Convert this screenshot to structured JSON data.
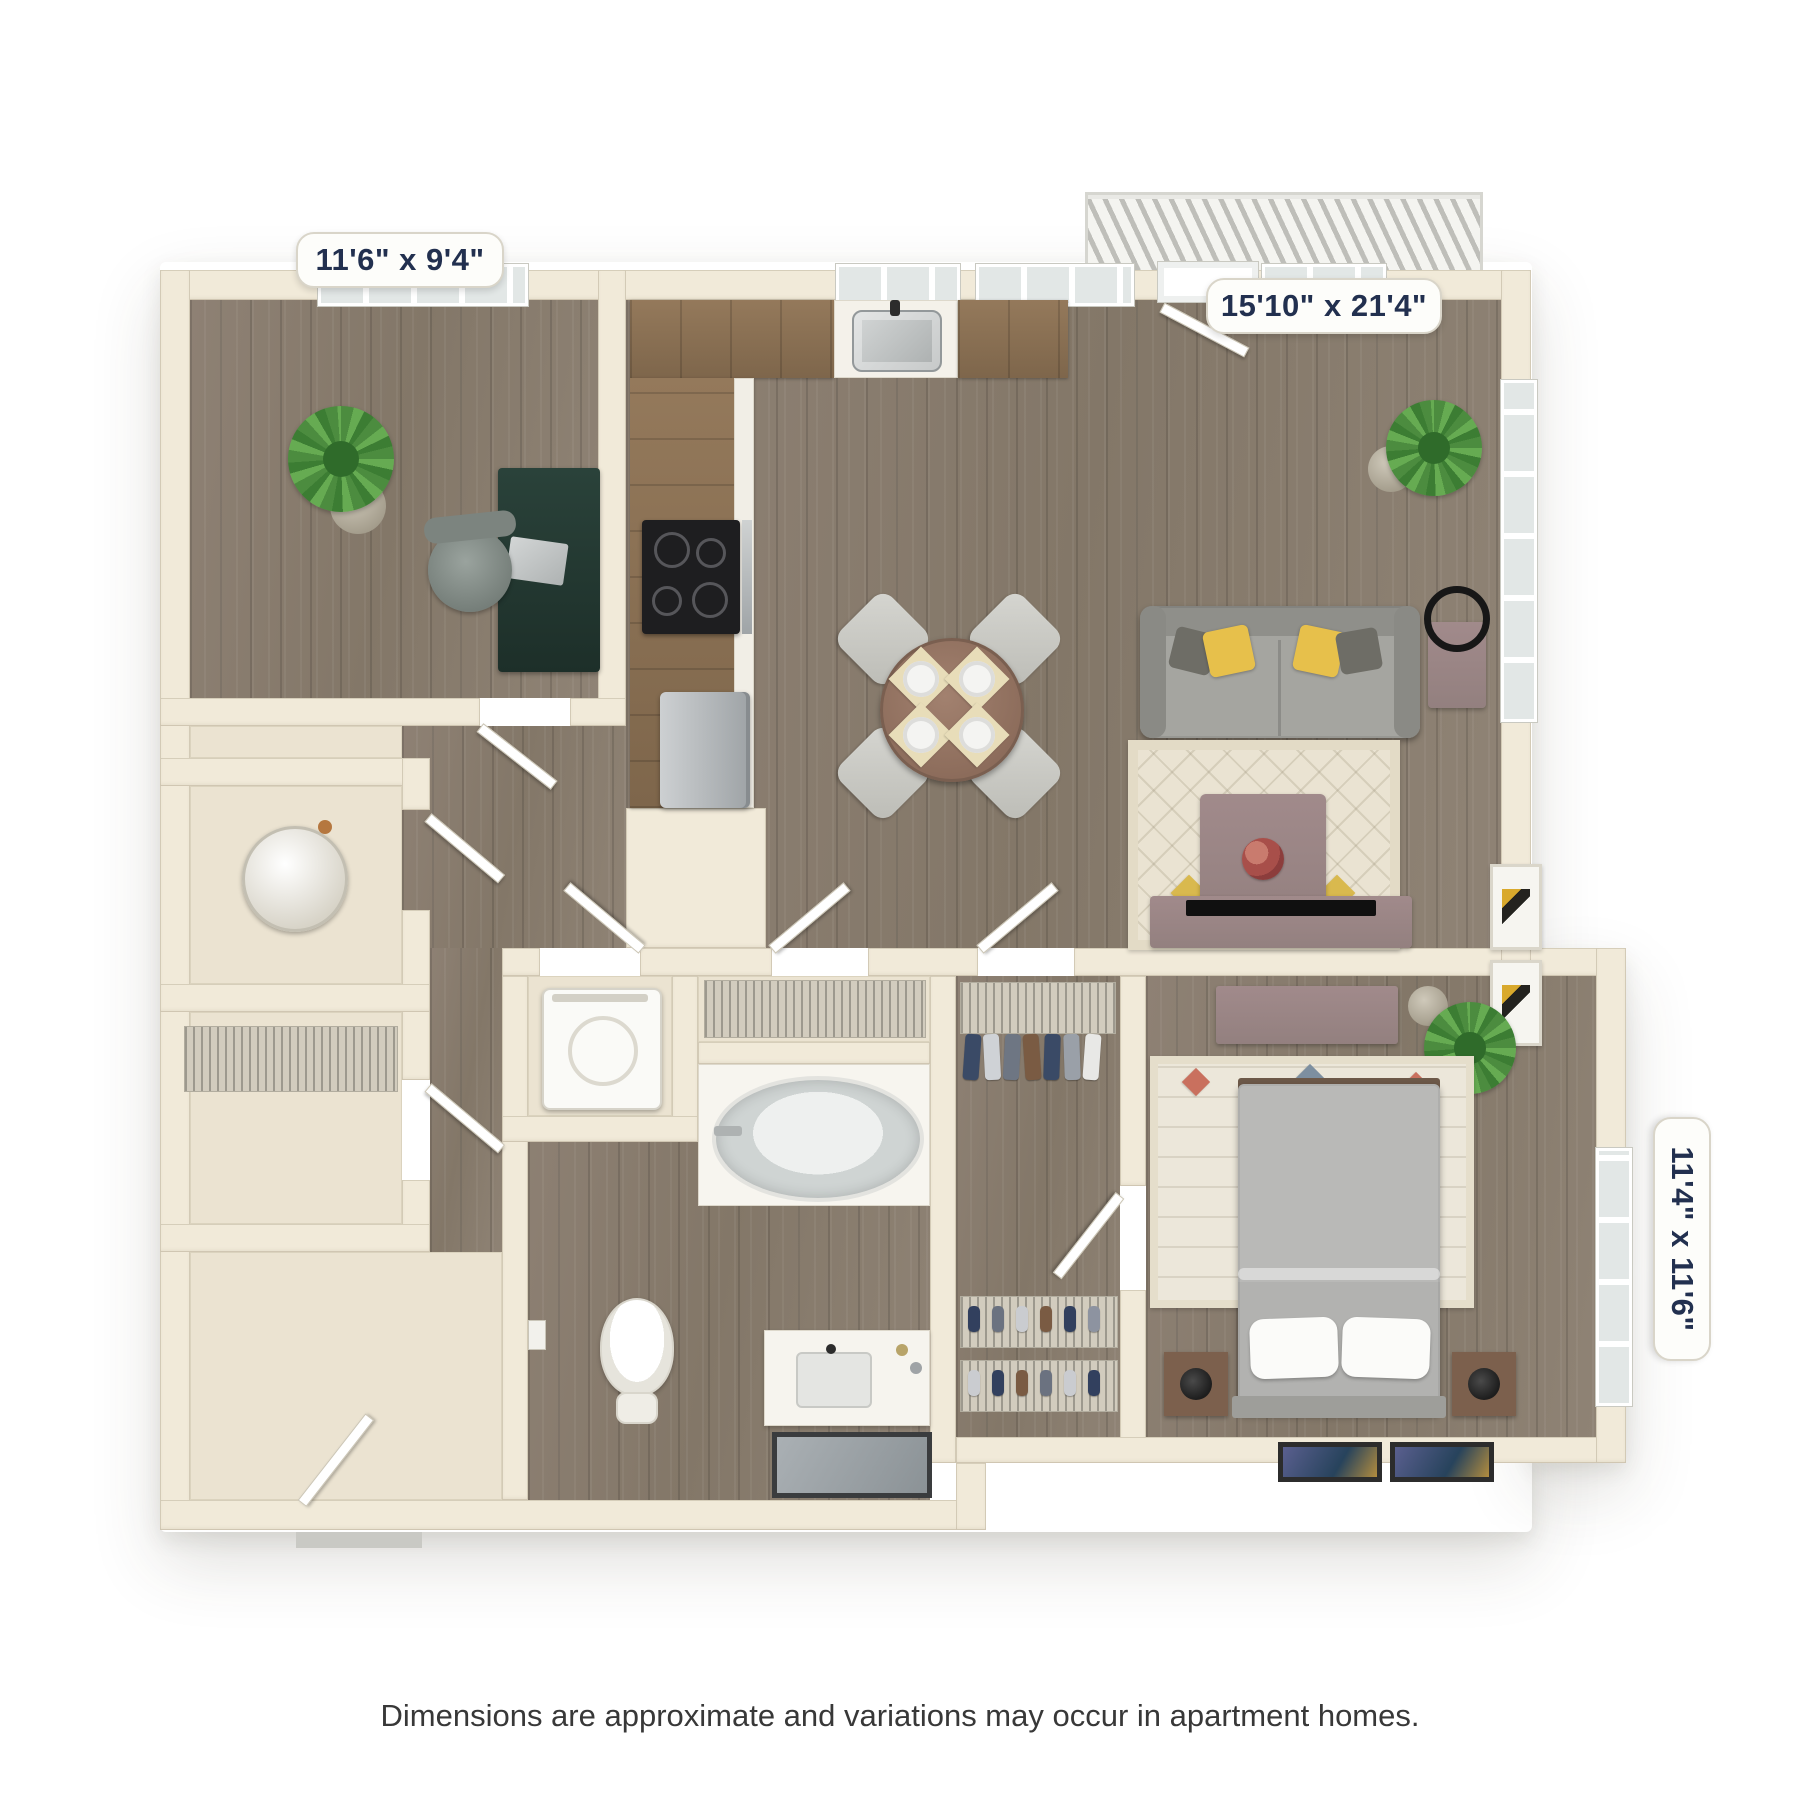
{
  "floor_plan": {
    "dimension_labels": {
      "room_top_left": "11'6\" x 9'4\"",
      "room_top_right": "15'10\" x 21'4\"",
      "room_bottom_right": "11'4\" x 11'6\""
    },
    "disclaimer": "Dimensions are approximate and variations may occur in apartment homes.",
    "colors": {
      "background": "#ffffff",
      "wall": "#f1ead9",
      "wood_floor": "#867a6d",
      "closet_floor": "#ebe3d1",
      "label_text": "#22304f",
      "sofa": "#9c9c97",
      "accent_pillow": "#e7c04b",
      "accent_furniture": "#9b8486",
      "plant": "#55994a",
      "rug": "#eae3d2"
    }
  }
}
